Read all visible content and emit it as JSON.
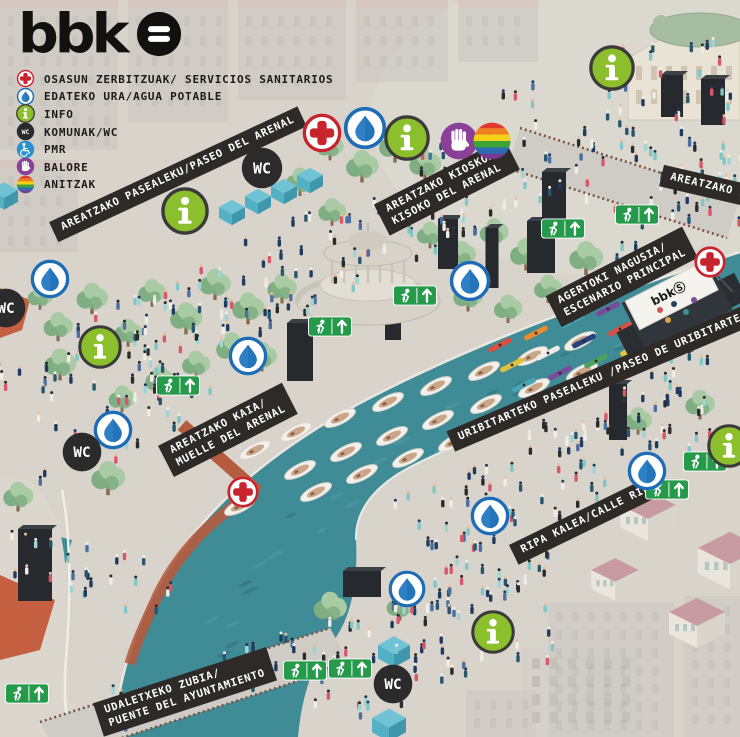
{
  "logo": {
    "text": "bbk"
  },
  "legend": {
    "items": [
      {
        "icon": "medical",
        "label": "OSASUN ZERBITZUAK/ SERVICIOS SANITARIOS"
      },
      {
        "icon": "water",
        "label": "EDATEKO URA/AGUA POTABLE"
      },
      {
        "icon": "info",
        "label": "INFO"
      },
      {
        "icon": "wc",
        "label": "KOMUNAK/WC"
      },
      {
        "icon": "pmr",
        "label": "PMR"
      },
      {
        "icon": "balore",
        "label": "BALORE"
      },
      {
        "icon": "anitzak",
        "label": "ANITZAK"
      }
    ]
  },
  "map_labels": [
    {
      "id": "areatzako-pasealeku",
      "lines": [
        "AREATZAKO PASEALEKU/PASEO DEL ARENAL"
      ],
      "x": 178,
      "y": 174,
      "rot": -25
    },
    {
      "id": "areatzako-kioskoa",
      "lines": [
        "AREATZAKO KIOSKOA/",
        "KISOKO DEL ARENAL"
      ],
      "x": 447,
      "y": 187,
      "rot": -27
    },
    {
      "id": "agertoki-nagusia",
      "lines": [
        "AGERTOKI NAGUSIA/",
        "ESCENARIO PRINCIPAL"
      ],
      "x": 622,
      "y": 277,
      "rot": -27
    },
    {
      "id": "areatzako-kaia",
      "lines": [
        "AREATZAKO KAIA/",
        "MUELLE DEL ARENAL"
      ],
      "x": 228,
      "y": 430,
      "rot": -27
    },
    {
      "id": "uribitarteko-pasealeku",
      "lines": [
        "URIBITARTEKO PASEALEKU /PASEO DE URIBITARTE"
      ],
      "x": 600,
      "y": 378,
      "rot": -23
    },
    {
      "id": "ripa-kalea",
      "lines": [
        "RIPA KALEA/CALLE RIPA"
      ],
      "x": 589,
      "y": 518,
      "rot": -26
    },
    {
      "id": "udaletxeko-zubia",
      "lines": [
        "UDALETXEKO ZUBIA/",
        "PUENTE DEL AYUNTAMIENTO"
      ],
      "x": 185,
      "y": 692,
      "rot": -18
    },
    {
      "id": "areatzako-zubia",
      "lines": [
        "AREATZAKO ZU"
      ],
      "x": 712,
      "y": 187,
      "rot": 13
    }
  ],
  "markers": [
    {
      "type": "medical",
      "x": 322,
      "y": 133,
      "d": 42
    },
    {
      "type": "water",
      "x": 365,
      "y": 128,
      "d": 46
    },
    {
      "type": "info",
      "x": 407,
      "y": 138,
      "d": 46
    },
    {
      "type": "balore",
      "x": 459,
      "y": 141,
      "d": 40
    },
    {
      "type": "anitzak",
      "x": 492,
      "y": 141,
      "d": 40
    },
    {
      "type": "wc",
      "x": 262,
      "y": 168,
      "d": 44
    },
    {
      "type": "info",
      "x": 185,
      "y": 211,
      "d": 48
    },
    {
      "type": "water",
      "x": 470,
      "y": 281,
      "d": 44
    },
    {
      "type": "water",
      "x": 248,
      "y": 356,
      "d": 42
    },
    {
      "type": "water",
      "x": 50,
      "y": 279,
      "d": 42
    },
    {
      "type": "wc",
      "x": 6,
      "y": 308,
      "d": 42
    },
    {
      "type": "info",
      "x": 100,
      "y": 347,
      "d": 44
    },
    {
      "type": "water",
      "x": 113,
      "y": 430,
      "d": 42
    },
    {
      "type": "wc",
      "x": 82,
      "y": 452,
      "d": 42
    },
    {
      "type": "medical",
      "x": 243,
      "y": 492,
      "d": 34
    },
    {
      "type": "info",
      "x": 612,
      "y": 68,
      "d": 46
    },
    {
      "type": "medical",
      "x": 710,
      "y": 262,
      "d": 34
    },
    {
      "type": "water",
      "x": 647,
      "y": 471,
      "d": 42
    },
    {
      "type": "info",
      "x": 729,
      "y": 446,
      "d": 44
    },
    {
      "type": "water",
      "x": 490,
      "y": 516,
      "d": 42
    },
    {
      "type": "water",
      "x": 407,
      "y": 589,
      "d": 40
    },
    {
      "type": "info",
      "x": 493,
      "y": 632,
      "d": 44
    },
    {
      "type": "wc",
      "x": 393,
      "y": 684,
      "d": 42
    }
  ],
  "exit_signs": [
    {
      "x": 637,
      "y": 214
    },
    {
      "x": 563,
      "y": 228
    },
    {
      "x": 415,
      "y": 295
    },
    {
      "x": 330,
      "y": 326
    },
    {
      "x": 178,
      "y": 385
    },
    {
      "x": 705,
      "y": 461
    },
    {
      "x": 667,
      "y": 489
    },
    {
      "x": 305,
      "y": 670
    },
    {
      "x": 350,
      "y": 668
    },
    {
      "x": 27,
      "y": 693
    }
  ],
  "colors": {
    "bg": "#d8d4cc",
    "river": "#3f8b96",
    "river_dark": "#35747f",
    "river_light": "#4d98a3",
    "ribbon_bg": "#2d2a27",
    "ribbon_text": "#ffffff",
    "text": "#1d1b1a",
    "medical": "#c8242d",
    "water": "#1e6cb5",
    "water_drop": "#2e7fc4",
    "info_green": "#8cbf2c",
    "info_ring": "#3a3a3a",
    "wc_black": "#2b2b2b",
    "pmr_blue": "#2a93cf",
    "balore_purple": "#8a3f98",
    "rainbow": [
      "#e03a2f",
      "#f07f1f",
      "#f5d216",
      "#3fa437",
      "#2b6cb3",
      "#77398f"
    ],
    "exit_green": "#259a4b",
    "cube_top": "#6fc3d4",
    "cube_left": "#53b1c5",
    "cube_right": "#3f97ac",
    "tree_light": "#a9cba4",
    "tree_dark": "#7fae83",
    "trunk": "#8a6a4e",
    "tower": "#26292d",
    "tower_top": "#3c4148",
    "stone": "#d7d3c9",
    "stone_edge": "#bdb9ae",
    "boat_hull": "#f3f0ea",
    "boat_inner": "#c9a689",
    "kayaks": [
      "#d94f42",
      "#e98b2e",
      "#46a5b4",
      "#7a4b9b",
      "#4ca15e",
      "#e3c13f",
      "#f0ede6",
      "#27427a"
    ],
    "crowd": [
      "#1f3b5e",
      "#27576f",
      "#7fc6c6",
      "#d8576b",
      "#f0ede6",
      "#2b2b2b",
      "#4a6fa0",
      "#9fd4d4"
    ],
    "heads": [
      "#2b2b2b",
      "#1f3b5e",
      "#e8c19e",
      "#f0ede6"
    ],
    "faded": "#c9c6bf",
    "faded_window": "#bab7b0",
    "faded_roof": "#d6bcb8",
    "house_roof": "#c79ba1",
    "house_wall": "#eae6de",
    "house_wall2": "#d9d5cd",
    "house_window": "#b7c5c3",
    "theatre_wall": "#e9e3d5",
    "theatre_roof": "#a7bda1",
    "bridge": "#cfccc5",
    "rail_brown": "#7a5240",
    "rust": "#b55b3e",
    "rail_light": "#e9e6df",
    "bank_light": "#9fb0b4"
  },
  "scene": {
    "river_path": "M 740 252 C 600 297, 470 345, 360 403 C 280 447, 225 492, 185 545 C 150 590, 128 645, 118 700 C 114 720, 113 730, 114 737 L 298 737 C 302 695, 312 665, 330 645 C 352 620, 358 580, 356 540 C 355 510, 375 485, 412 466 C 450 447, 490 430, 540 410 C 590 390, 660 358, 740 330 Z",
    "river_left_wedge": "M 0 522 L 72 540 L 60 582 L 0 588 Z",
    "upper_bank_stroke": "M 740 252 C 600 297, 470 345, 360 403 C 280 447, 225 492, 185 545 C 150 590, 128 645, 118 700",
    "lower_bank_stroke": "M 356 540 C 355 510, 375 485, 412 466 C 450 447, 490 430, 540 410 C 590 390, 660 358, 740 330",
    "walkway_path": "M 28 480 C 55 500, 68 540, 66 600 C 64 660, 68 705, 78 737 L 0 737 L 0 478 Z",
    "walkway_rail": "M 62 490 C 72 540, 70 610, 66 660 C 63 700, 66 720, 72 737",
    "ramp1": "M 182 425 L 258 492",
    "ramp2": "M 256 492 C 215 515, 180 550, 158 595 C 144 625, 134 648, 130 664",
    "bridge_bottom": [
      [
        40,
        722
      ],
      [
        330,
        628
      ],
      [
        350,
        664
      ],
      [
        60,
        758
      ]
    ],
    "bridge_top": [
      [
        520,
        128
      ],
      [
        740,
        198
      ],
      [
        727,
        238
      ],
      [
        507,
        168
      ]
    ],
    "faded_tl": [
      [
        0,
        0,
        118,
        150
      ],
      [
        128,
        0,
        100,
        122
      ],
      [
        238,
        0,
        108,
        100
      ],
      [
        356,
        0,
        92,
        82
      ],
      [
        458,
        0,
        80,
        62
      ],
      [
        0,
        160,
        78,
        92
      ]
    ],
    "faded_br": [
      [
        548,
        602,
        126,
        135
      ],
      [
        684,
        596,
        56,
        141
      ],
      [
        466,
        690,
        70,
        47
      ]
    ],
    "orange_roofs": [
      [
        0,
        575,
        55,
        600,
        40,
        650,
        0,
        660
      ],
      [
        0,
        288,
        30,
        300,
        22,
        330,
        0,
        338
      ]
    ],
    "building_bc": [
      522,
      648,
      120,
      89
    ],
    "theatre": {
      "x": 628,
      "y": 28,
      "w": 112,
      "h": 92
    },
    "houses": [
      [
        648,
        505,
        40
      ],
      [
        730,
        548,
        46
      ],
      [
        615,
        570,
        34
      ],
      [
        697,
        612,
        40
      ]
    ],
    "cubes": [
      [
        232,
        207,
        26
      ],
      [
        258,
        196,
        26
      ],
      [
        284,
        186,
        26
      ],
      [
        310,
        175,
        26
      ],
      [
        4,
        190,
        28
      ],
      [
        394,
        645,
        32
      ],
      [
        391,
        677,
        32
      ],
      [
        389,
        718,
        34
      ]
    ],
    "towers": [
      [
        35,
        565,
        34,
        72
      ],
      [
        300,
        352,
        26,
        58
      ],
      [
        393,
        315,
        16,
        50
      ],
      [
        448,
        244,
        20,
        50
      ],
      [
        541,
        247,
        28,
        52
      ],
      [
        492,
        258,
        13,
        60
      ],
      [
        554,
        196,
        24,
        48
      ],
      [
        618,
        412,
        18,
        56
      ],
      [
        672,
        96,
        22,
        42
      ],
      [
        713,
        102,
        24,
        46
      ],
      [
        362,
        584,
        38,
        26
      ]
    ],
    "trees": [
      [
        58,
        330
      ],
      [
        92,
        302
      ],
      [
        128,
        336
      ],
      [
        152,
        296
      ],
      [
        186,
        322
      ],
      [
        215,
        288
      ],
      [
        248,
        312
      ],
      [
        282,
        292
      ],
      [
        232,
        352
      ],
      [
        196,
        368
      ],
      [
        160,
        384
      ],
      [
        122,
        402
      ],
      [
        262,
        360
      ],
      [
        60,
        368
      ],
      [
        40,
        300
      ],
      [
        330,
        150
      ],
      [
        362,
        170
      ],
      [
        395,
        150
      ],
      [
        425,
        168
      ],
      [
        300,
        185
      ],
      [
        332,
        215
      ],
      [
        398,
        213
      ],
      [
        430,
        238
      ],
      [
        462,
        258
      ],
      [
        494,
        236
      ],
      [
        526,
        258
      ],
      [
        548,
        292
      ],
      [
        586,
        262
      ],
      [
        468,
        300
      ],
      [
        508,
        312
      ],
      [
        638,
        424
      ],
      [
        700,
        408
      ],
      [
        400,
        610
      ],
      [
        330,
        612
      ],
      [
        18,
        500
      ],
      [
        108,
        482
      ]
    ],
    "kiosko": {
      "x": 368,
      "y": 283
    },
    "stagep": {
      "x": 678,
      "y": 308
    },
    "boats": [
      [
        255,
        450
      ],
      [
        296,
        432
      ],
      [
        340,
        418
      ],
      [
        388,
        402
      ],
      [
        436,
        386
      ],
      [
        484,
        371
      ],
      [
        532,
        356
      ],
      [
        580,
        341
      ],
      [
        300,
        470
      ],
      [
        346,
        452
      ],
      [
        392,
        436
      ],
      [
        438,
        420
      ],
      [
        486,
        404
      ],
      [
        534,
        388
      ],
      [
        582,
        372
      ],
      [
        316,
        492
      ],
      [
        362,
        474
      ],
      [
        408,
        458
      ],
      [
        454,
        442
      ],
      [
        500,
        426
      ],
      [
        240,
        506
      ],
      [
        700,
        272
      ]
    ],
    "kayaks": [
      [
        500,
        345,
        0
      ],
      [
        536,
        333,
        1
      ],
      [
        572,
        321,
        2
      ],
      [
        608,
        309,
        3
      ],
      [
        644,
        297,
        4
      ],
      [
        512,
        365,
        5
      ],
      [
        548,
        353,
        6
      ],
      [
        584,
        341,
        7
      ],
      [
        620,
        329,
        0
      ],
      [
        656,
        317,
        1
      ],
      [
        524,
        385,
        2
      ],
      [
        560,
        373,
        3
      ],
      [
        596,
        361,
        4
      ],
      [
        632,
        349,
        5
      ],
      [
        676,
        338,
        6
      ],
      [
        700,
        322,
        7
      ]
    ],
    "speckle_line": [
      [
        740,
        290
      ],
      [
        700,
        305
      ],
      [
        660,
        322
      ],
      [
        620,
        340
      ],
      [
        580,
        358
      ],
      [
        540,
        377
      ],
      [
        500,
        397
      ],
      [
        460,
        418
      ],
      [
        420,
        440
      ],
      [
        380,
        465
      ],
      [
        340,
        492
      ],
      [
        300,
        522
      ],
      [
        270,
        552
      ],
      [
        245,
        582
      ],
      [
        225,
        612
      ],
      [
        210,
        645
      ],
      [
        195,
        680
      ],
      [
        185,
        710
      ]
    ],
    "crowd_zones": [
      {
        "cx": 320,
        "cy": 258,
        "w": 460,
        "h": 95,
        "rot": -26,
        "n": 140
      },
      {
        "cx": 620,
        "cy": 130,
        "w": 240,
        "h": 150,
        "rot": -18,
        "n": 70
      },
      {
        "cx": 110,
        "cy": 390,
        "w": 200,
        "h": 140,
        "rot": -20,
        "n": 50
      },
      {
        "cx": 565,
        "cy": 462,
        "w": 350,
        "h": 95,
        "rot": -26,
        "n": 100
      },
      {
        "cx": 430,
        "cy": 648,
        "w": 250,
        "h": 105,
        "rot": -12,
        "n": 65
      },
      {
        "cx": 82,
        "cy": 575,
        "w": 70,
        "h": 180,
        "rot": -78,
        "n": 26
      },
      {
        "cx": 480,
        "cy": 580,
        "w": 150,
        "h": 70,
        "rot": -22,
        "n": 35
      },
      {
        "cx": 215,
        "cy": 680,
        "w": 240,
        "h": 42,
        "rot": -17,
        "n": 22
      },
      {
        "cx": 680,
        "cy": 215,
        "w": 150,
        "h": 60,
        "rot": -20,
        "n": 25
      }
    ]
  }
}
